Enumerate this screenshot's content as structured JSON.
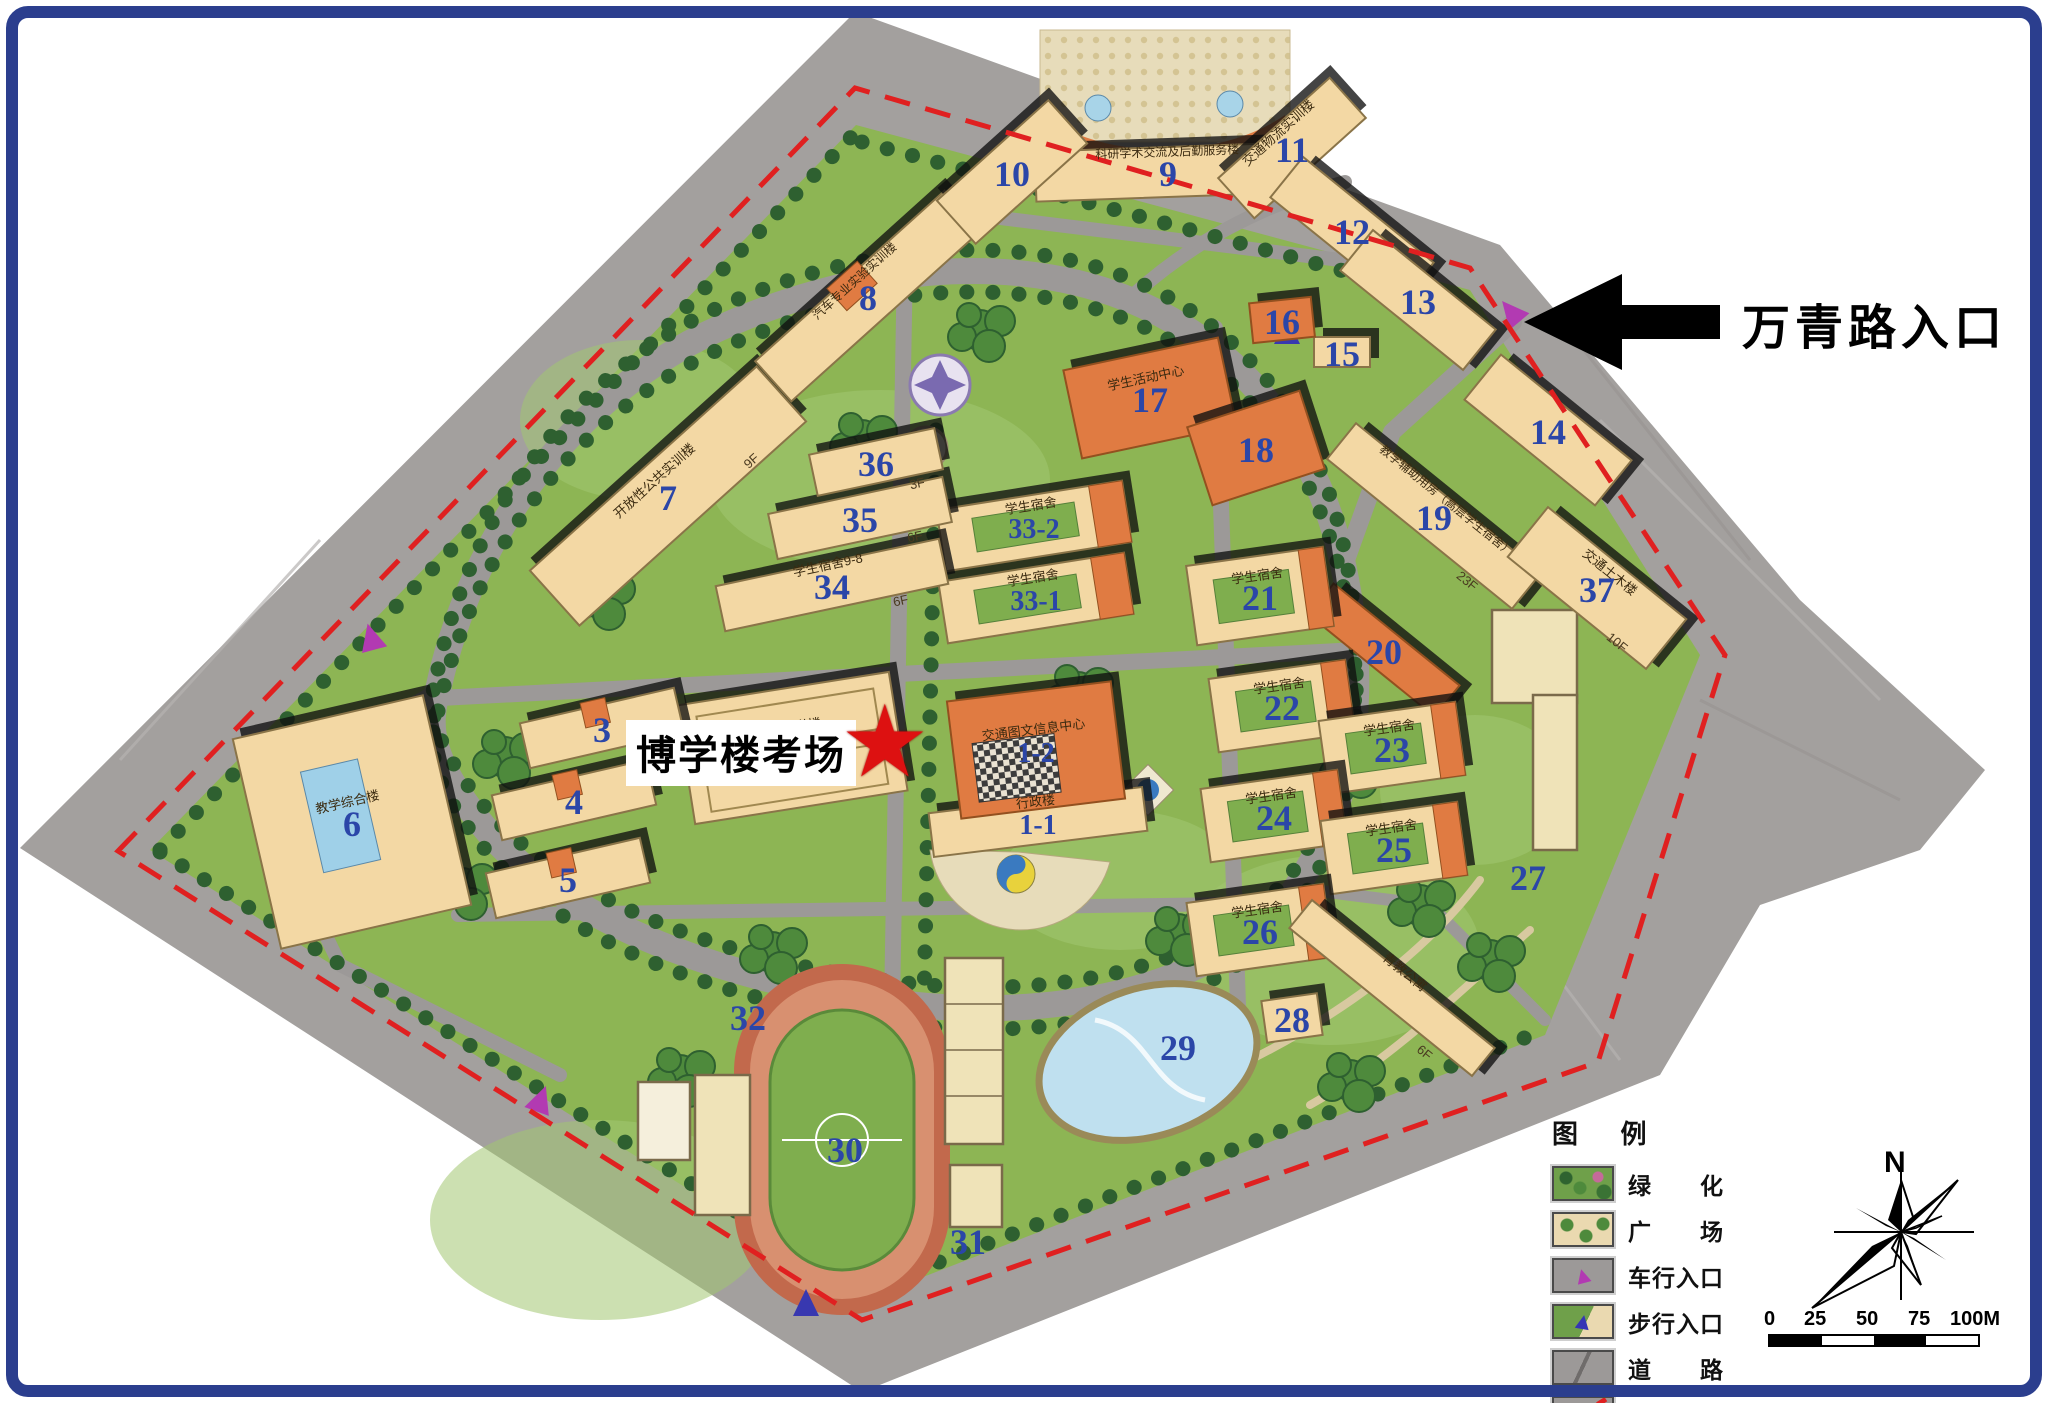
{
  "annotations": {
    "entrance_label": "万青路入口",
    "exam_label": "博学楼考场",
    "star_glyph": "★"
  },
  "legend": {
    "title": "图  例",
    "items": [
      {
        "type": "greenery",
        "label": "绿　　化"
      },
      {
        "type": "plaza",
        "label": "广　　场"
      },
      {
        "type": "vehicle-entrance",
        "label": "车行入口"
      },
      {
        "type": "pedestrian-entrance",
        "label": "步行入口"
      },
      {
        "type": "road",
        "label": "道　　路"
      },
      {
        "type": "red-line",
        "label": "用地红线"
      }
    ],
    "marker_glyph": "▲"
  },
  "compass": {
    "north_label": "N"
  },
  "scale_bar": {
    "labels": [
      "0",
      "25",
      "50",
      "75",
      "100M"
    ]
  },
  "colors": {
    "campus_green": "#8db554",
    "lawn_light": "#a3c671",
    "land_gray": "#a3a09e",
    "road_gray": "#9c9998",
    "beige": "#f3d8a4",
    "beige_stroke": "#8a7448",
    "orange": "#e07b42",
    "orange_stroke": "#93501f",
    "courtyard_green": "#7fae4e",
    "number_blue": "#2b46a8",
    "name_ink": "#3a2a10",
    "red_line": "#e02020",
    "tree_dark": "#2e6030",
    "tree_mid": "#4e8a3c",
    "track_ring": "#c2694c",
    "track_lane": "#d89070",
    "pond_blue": "#bfe0ef",
    "plaza_tan": "#e7dcba",
    "court_tan": "#efe3b8",
    "shadow": "rgba(15,15,15,0.78)"
  },
  "map": {
    "buildings": [
      {
        "num": "1-1",
        "name": "行政楼",
        "x": 1038,
        "y": 822,
        "w": 215,
        "h": 44,
        "rot": -7,
        "kind": "beige"
      },
      {
        "num": "1-2",
        "name": "交通图文信息中心",
        "x": 1036,
        "y": 750,
        "w": 165,
        "h": 118,
        "rot": -7,
        "kind": "orange",
        "hatch": true
      },
      {
        "num": "2",
        "name": "基础教学楼",
        "x": 792,
        "y": 748,
        "w": 215,
        "h": 120,
        "rot": -9,
        "kind": "complex"
      },
      {
        "num": "3",
        "x": 602,
        "y": 728,
        "w": 158,
        "h": 46,
        "rot": -13,
        "kind": "beige",
        "cap": true
      },
      {
        "num": "4",
        "x": 574,
        "y": 800,
        "w": 158,
        "h": 46,
        "rot": -13,
        "kind": "beige",
        "cap": true
      },
      {
        "num": "5",
        "x": 568,
        "y": 878,
        "w": 158,
        "h": 46,
        "rot": -13,
        "kind": "beige",
        "cap": true
      },
      {
        "num": "6",
        "name": "教学综合楼",
        "x": 352,
        "y": 822,
        "w": 195,
        "h": 215,
        "rot": -13,
        "kind": "complex6"
      },
      {
        "num": "7",
        "name": "开放性公共实训楼",
        "floors": "9F",
        "x": 668,
        "y": 496,
        "w": 305,
        "h": 74,
        "rot": -42,
        "kind": "beige"
      },
      {
        "num": "8",
        "name": "汽车专业实验实训楼",
        "x": 868,
        "y": 296,
        "w": 255,
        "h": 54,
        "rot": -42,
        "kind": "beige",
        "cap": true
      },
      {
        "num": "9",
        "name": "科研学术交流及后勤服务楼",
        "x": 1168,
        "y": 172,
        "w": 265,
        "h": 50,
        "rot": -2,
        "kind": "beige"
      },
      {
        "num": "10",
        "x": 1012,
        "y": 172,
        "w": 150,
        "h": 58,
        "rot": -42,
        "kind": "beige"
      },
      {
        "num": "11",
        "name": "交通物流实训楼",
        "x": 1292,
        "y": 148,
        "w": 150,
        "h": 54,
        "rot": -42,
        "kind": "beige"
      },
      {
        "num": "12",
        "x": 1352,
        "y": 230,
        "w": 168,
        "h": 52,
        "rot": 39,
        "kind": "beige"
      },
      {
        "num": "13",
        "x": 1418,
        "y": 300,
        "w": 158,
        "h": 52,
        "rot": 39,
        "kind": "beige"
      },
      {
        "num": "14",
        "x": 1548,
        "y": 430,
        "w": 168,
        "h": 58,
        "rot": 39,
        "kind": "beige"
      },
      {
        "num": "15",
        "x": 1342,
        "y": 352,
        "w": 56,
        "h": 30,
        "rot": 0,
        "kind": "beige"
      },
      {
        "num": "16",
        "x": 1282,
        "y": 320,
        "w": 62,
        "h": 40,
        "rot": -6,
        "kind": "orange"
      },
      {
        "num": "17",
        "name": "学生活动中心",
        "x": 1150,
        "y": 398,
        "w": 158,
        "h": 90,
        "rot": -12,
        "kind": "orange"
      },
      {
        "num": "18",
        "x": 1256,
        "y": 448,
        "w": 118,
        "h": 82,
        "rot": -18,
        "kind": "orange"
      },
      {
        "num": "19",
        "name": "教学辅助用房（高层学生宿舍）",
        "floors": "23F",
        "x": 1434,
        "y": 516,
        "w": 238,
        "h": 46,
        "rot": 39,
        "kind": "beige"
      },
      {
        "num": "20",
        "x": 1384,
        "y": 650,
        "w": 162,
        "h": 40,
        "rot": 39,
        "kind": "orange"
      },
      {
        "num": "21",
        "name": "学生宿舍",
        "x": 1260,
        "y": 596,
        "w": 138,
        "h": 80,
        "rot": -8,
        "kind": "dorm"
      },
      {
        "num": "22",
        "name": "学生宿舍",
        "x": 1282,
        "y": 706,
        "w": 138,
        "h": 74,
        "rot": -8,
        "kind": "dorm"
      },
      {
        "num": "23",
        "name": "学生宿舍",
        "x": 1392,
        "y": 748,
        "w": 138,
        "h": 74,
        "rot": -8,
        "kind": "dorm"
      },
      {
        "num": "24",
        "name": "学生宿舍",
        "x": 1274,
        "y": 816,
        "w": 138,
        "h": 74,
        "rot": -8,
        "kind": "dorm"
      },
      {
        "num": "25",
        "name": "学生宿舍",
        "x": 1394,
        "y": 848,
        "w": 138,
        "h": 74,
        "rot": -8,
        "kind": "dorm"
      },
      {
        "num": "26",
        "name": "学生宿舍",
        "x": 1260,
        "y": 930,
        "w": 138,
        "h": 74,
        "rot": -8,
        "kind": "dorm"
      },
      {
        "num": "27",
        "x": 1528,
        "y": 876,
        "kind": "label"
      },
      {
        "num": "28",
        "x": 1292,
        "y": 1018,
        "w": 56,
        "h": 42,
        "rot": -8,
        "kind": "beige"
      },
      {
        "num": "29",
        "x": 1178,
        "y": 1046,
        "kind": "label"
      },
      {
        "num": "30",
        "x": 845,
        "y": 1148,
        "kind": "label"
      },
      {
        "num": "31",
        "x": 968,
        "y": 1240,
        "kind": "label"
      },
      {
        "num": "32",
        "x": 748,
        "y": 1016,
        "kind": "label"
      },
      {
        "num": "33-1",
        "name": "学生宿舍",
        "x": 1036,
        "y": 598,
        "w": 188,
        "h": 62,
        "rot": -9,
        "kind": "dorm"
      },
      {
        "num": "33-2",
        "name": "学生宿舍",
        "x": 1034,
        "y": 526,
        "w": 188,
        "h": 62,
        "rot": -9,
        "kind": "dorm"
      },
      {
        "num": "34",
        "name": "学生宿舍9-8",
        "floors": "6F",
        "x": 832,
        "y": 585,
        "w": 228,
        "h": 46,
        "rot": -12,
        "kind": "beige"
      },
      {
        "num": "35",
        "floors": "6F",
        "x": 860,
        "y": 518,
        "w": 178,
        "h": 46,
        "rot": -12,
        "kind": "beige"
      },
      {
        "num": "36",
        "floors": "3F",
        "x": 876,
        "y": 462,
        "w": 128,
        "h": 42,
        "rot": -12,
        "kind": "beige"
      },
      {
        "num": "37",
        "name": "交通土木楼",
        "floors": "10F",
        "x": 1597,
        "y": 588,
        "w": 178,
        "h": 64,
        "rot": 39,
        "kind": "beige"
      },
      {
        "num": "",
        "name": "青教公寓",
        "floors": "6F",
        "x": 1392,
        "y": 988,
        "w": 235,
        "h": 36,
        "rot": 39,
        "kind": "beige"
      }
    ]
  }
}
